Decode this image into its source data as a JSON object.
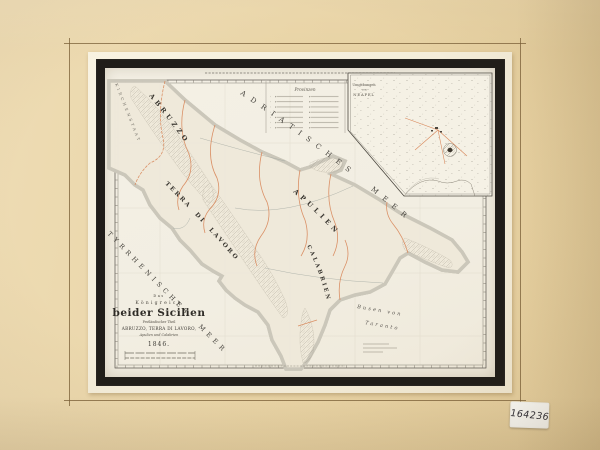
{
  "artifact": {
    "inventory_tag": "164236",
    "sheet_number": "6"
  },
  "map": {
    "title_block": {
      "pretitle": "Das",
      "title_upper": "Königreich",
      "title_main": "beider Sicilien",
      "subtitle": "Festländischer Theil",
      "subtitle_regions": "ABRUZZO, TERRA DI LAVORO,",
      "subtitle_regions2": "Apulien und Calabrien",
      "year": "1846."
    },
    "legend": {
      "title": "Provinzen"
    },
    "inset": {
      "title_l1": "Umgebungen",
      "title_l2": "von",
      "title_l3": "NEAPEL"
    },
    "sea_labels": {
      "adriatic": "ADRIATISCHES MEER",
      "tyrrhenian": "TYRRHENISCHES MEER",
      "gulf_l1": "Busen von",
      "gulf_l2": "Taranto"
    },
    "region_labels": {
      "border_state": "KIRCHENSTAAT",
      "abruzzo": "ABRUZZO",
      "terra_di_lavoro": "TERRA DI LAVORO",
      "apulien": "APULIEN",
      "calabrien": "CALABRIEN"
    }
  }
}
